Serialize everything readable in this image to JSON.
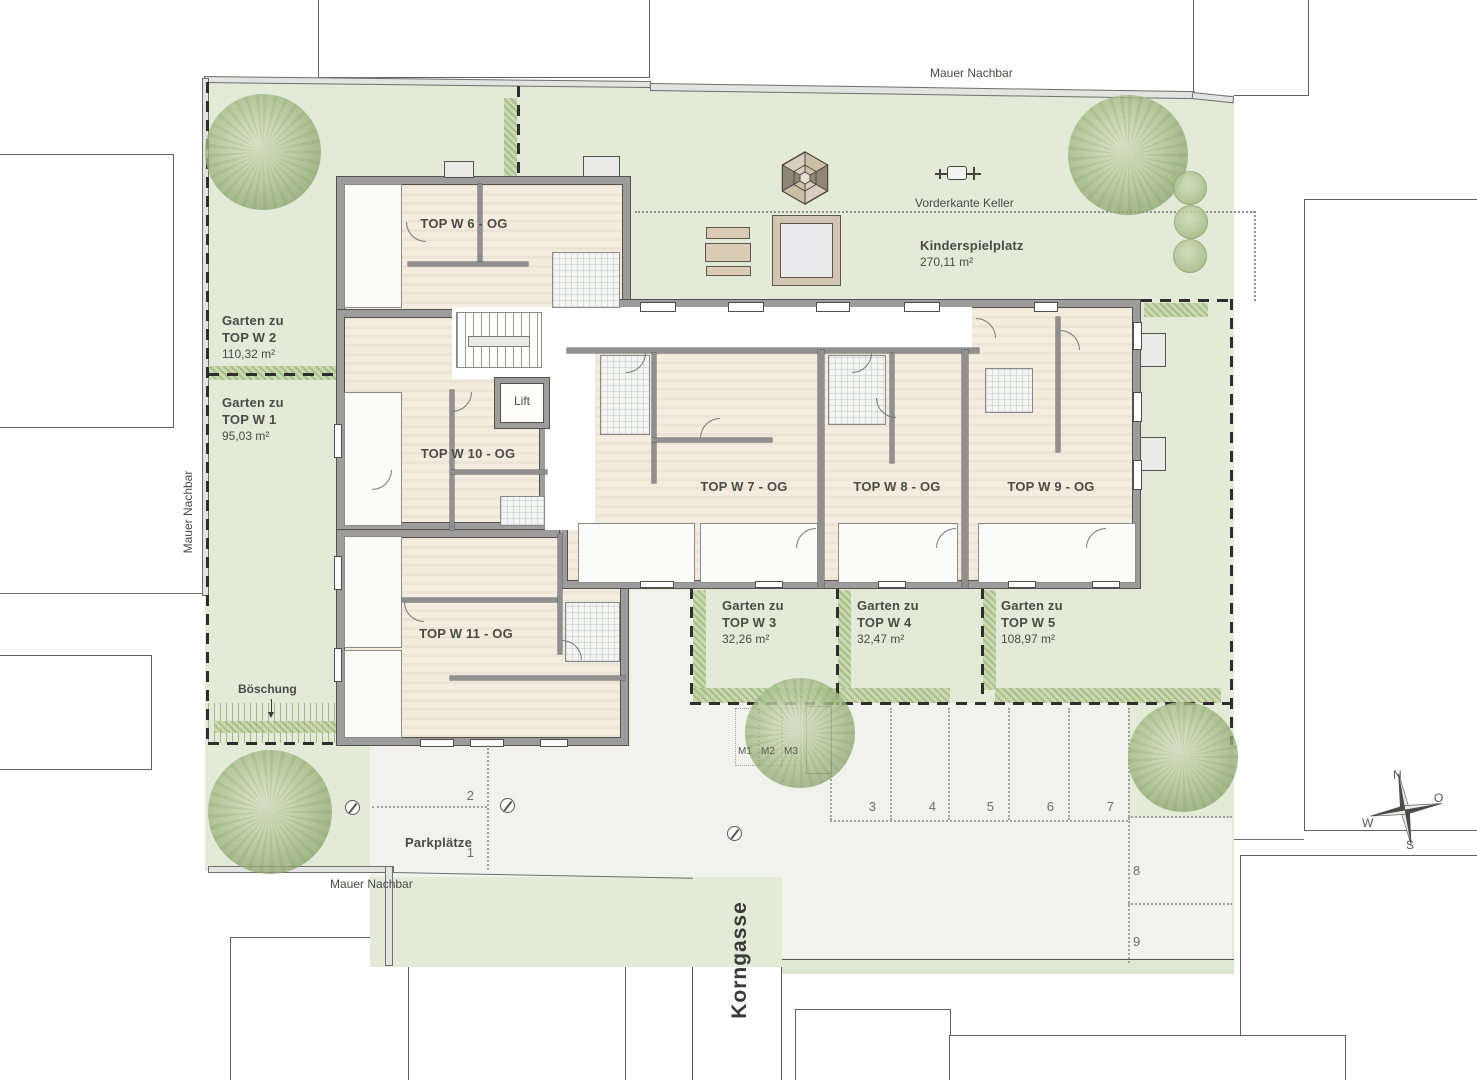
{
  "site": {
    "boundary": {
      "top": "Mauer Nachbar",
      "left": "Mauer Nachbar",
      "bottom": "Mauer Nachbar"
    },
    "street_name": "Korngasse",
    "slope_label": "Böschung"
  },
  "playground": {
    "name": "Kinderspielplatz",
    "area": "270,11 m²",
    "keller_line_label": "Vorderkante Keller"
  },
  "building": {
    "lift_label": "Lift",
    "apartments": [
      {
        "label": "TOP W 6 - OG"
      },
      {
        "label": "TOP W 10 - OG"
      },
      {
        "label": "TOP W 11 - OG"
      },
      {
        "label": "TOP W 7 - OG"
      },
      {
        "label": "TOP W 8 - OG"
      },
      {
        "label": "TOP W 9 - OG"
      }
    ]
  },
  "gardens": [
    {
      "prefix": "Garten zu",
      "unit": "TOP W 2",
      "area": "110,32 m²"
    },
    {
      "prefix": "Garten zu",
      "unit": "TOP W 1",
      "area": "95,03 m²"
    },
    {
      "prefix": "Garten zu",
      "unit": "TOP W 3",
      "area": "32,26 m²"
    },
    {
      "prefix": "Garten zu",
      "unit": "TOP W 4",
      "area": "32,47 m²"
    },
    {
      "prefix": "Garten zu",
      "unit": "TOP W 5",
      "area": "108,97 m²"
    }
  ],
  "parking": {
    "title": "Parkplätze",
    "numbers": [
      "1",
      "2",
      "3",
      "4",
      "5",
      "6",
      "7",
      "8",
      "9"
    ],
    "moto": [
      "M1",
      "M2",
      "M3"
    ]
  },
  "compass": {
    "north": "N",
    "east": "O",
    "south": "S",
    "west": "W"
  },
  "colors": {
    "site_green": "#e3ead7",
    "room_beige": "#f3ecdf",
    "wall_gray": "#9c9c9c",
    "hatch_green": "#a8bf85",
    "parking_gray": "#f1f1ee",
    "boundary_dark": "#2e2e2e"
  }
}
